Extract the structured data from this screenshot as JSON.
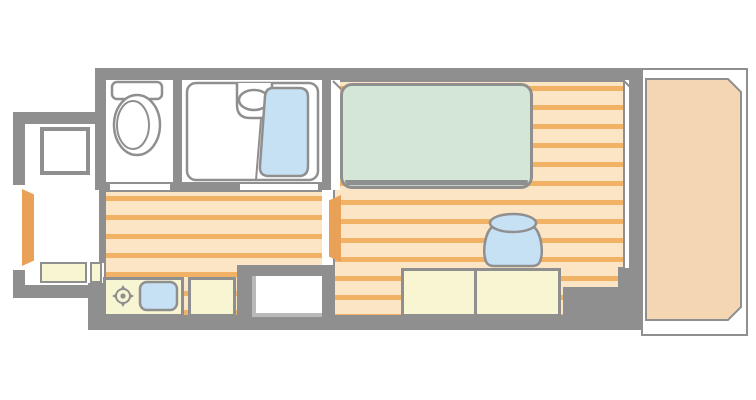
{
  "meta": {
    "image_type": "apartment floor plan diagram",
    "canvas": {
      "width": 756,
      "height": 400
    },
    "visible_text": "none"
  },
  "palette": {
    "wall": "#8f8f8f",
    "background": "#ffffff",
    "floor_base": "#fbe5c4",
    "floor_stripe": "#f1b265",
    "balcony_floor": "#f5d6b2",
    "bed": "#d4e6d5",
    "water_blue": "#c5e1f3",
    "furniture_cream": "#f8f5d3",
    "door_orange": "#e9a057"
  },
  "rooms": [
    {
      "id": "entrance",
      "kind": "genkan entry with step"
    },
    {
      "id": "toilet-room",
      "kind": "toilet room"
    },
    {
      "id": "bathroom",
      "kind": "unit bath"
    },
    {
      "id": "kitchen-hallway",
      "kind": "kitchen corridor with wood-strip flooring"
    },
    {
      "id": "main-room",
      "kind": "main living room with wood-strip flooring"
    },
    {
      "id": "utility-niche",
      "kind": "recessed utility / washer space"
    },
    {
      "id": "balcony",
      "kind": "balcony with railing outline"
    }
  ],
  "fixtures": [
    {
      "id": "front-door",
      "type": "door-leaf",
      "room": "entrance"
    },
    {
      "id": "shoe-cabinet",
      "type": "cabinet",
      "room": "entrance"
    },
    {
      "id": "entrance-step",
      "type": "step-board",
      "room": "entrance"
    },
    {
      "id": "toilet",
      "type": "toilet-with-tank",
      "room": "toilet-room"
    },
    {
      "id": "washbasin",
      "type": "oval-sink",
      "room": "bathroom"
    },
    {
      "id": "bathtub",
      "type": "bathtub",
      "room": "bathroom"
    },
    {
      "id": "kitchen-counter",
      "type": "counter",
      "room": "kitchen-hallway"
    },
    {
      "id": "stove-burner",
      "type": "single-burner-symbol",
      "room": "kitchen-hallway"
    },
    {
      "id": "kitchen-sink",
      "type": "sink-basin",
      "room": "kitchen-hallway"
    },
    {
      "id": "interior-door",
      "type": "door-leaf",
      "room": "main-room"
    },
    {
      "id": "bed",
      "type": "single-bed",
      "room": "main-room"
    },
    {
      "id": "stool",
      "type": "round-stool",
      "room": "main-room"
    },
    {
      "id": "desk",
      "type": "two-section-desk",
      "room": "main-room"
    },
    {
      "id": "balcony-deck",
      "type": "deck-floor",
      "room": "balcony"
    }
  ]
}
